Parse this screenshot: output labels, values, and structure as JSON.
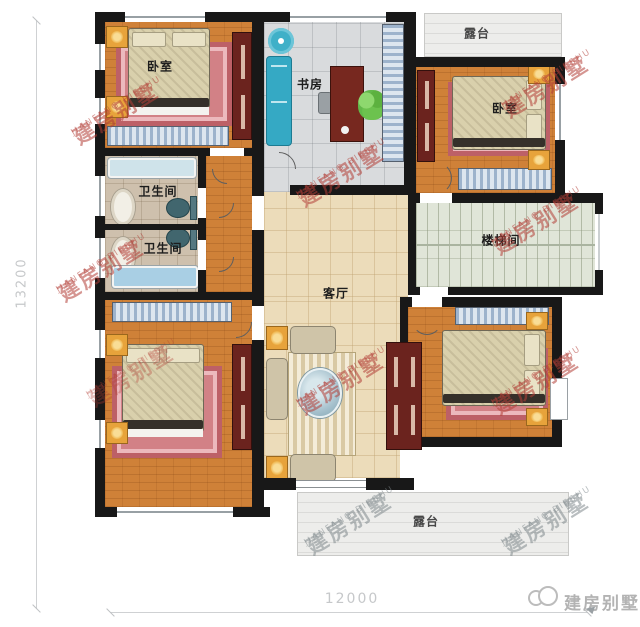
{
  "rooms": {
    "bedroom_top_left": "卧室",
    "bedroom_top_right": "卧室",
    "study": "书房",
    "bathroom_upper": "卫生间",
    "bathroom_lower": "卫生间",
    "living_room": "客厅",
    "stairwell": "楼梯间",
    "terrace_top": "露台",
    "terrace_bottom": "露台"
  },
  "dimensions": {
    "horizontal": "12000",
    "vertical": "13200"
  },
  "watermark": {
    "line1": "建房别墅",
    "line2": "JIANFANG BIESHU"
  },
  "logo": {
    "name": "建房别墅"
  },
  "colors": {
    "wall": "#181818",
    "floor_wood": "#cf8138",
    "floor_tile": "#ecdcba",
    "rug_pink": "#d28186",
    "cabinet_red": "#6b231e",
    "wardrobe_blue": "#9db3cc",
    "watermark_red": "#b23e36",
    "watermark_gray": "#80888d",
    "dimension_gray": "#c6c8ca"
  }
}
